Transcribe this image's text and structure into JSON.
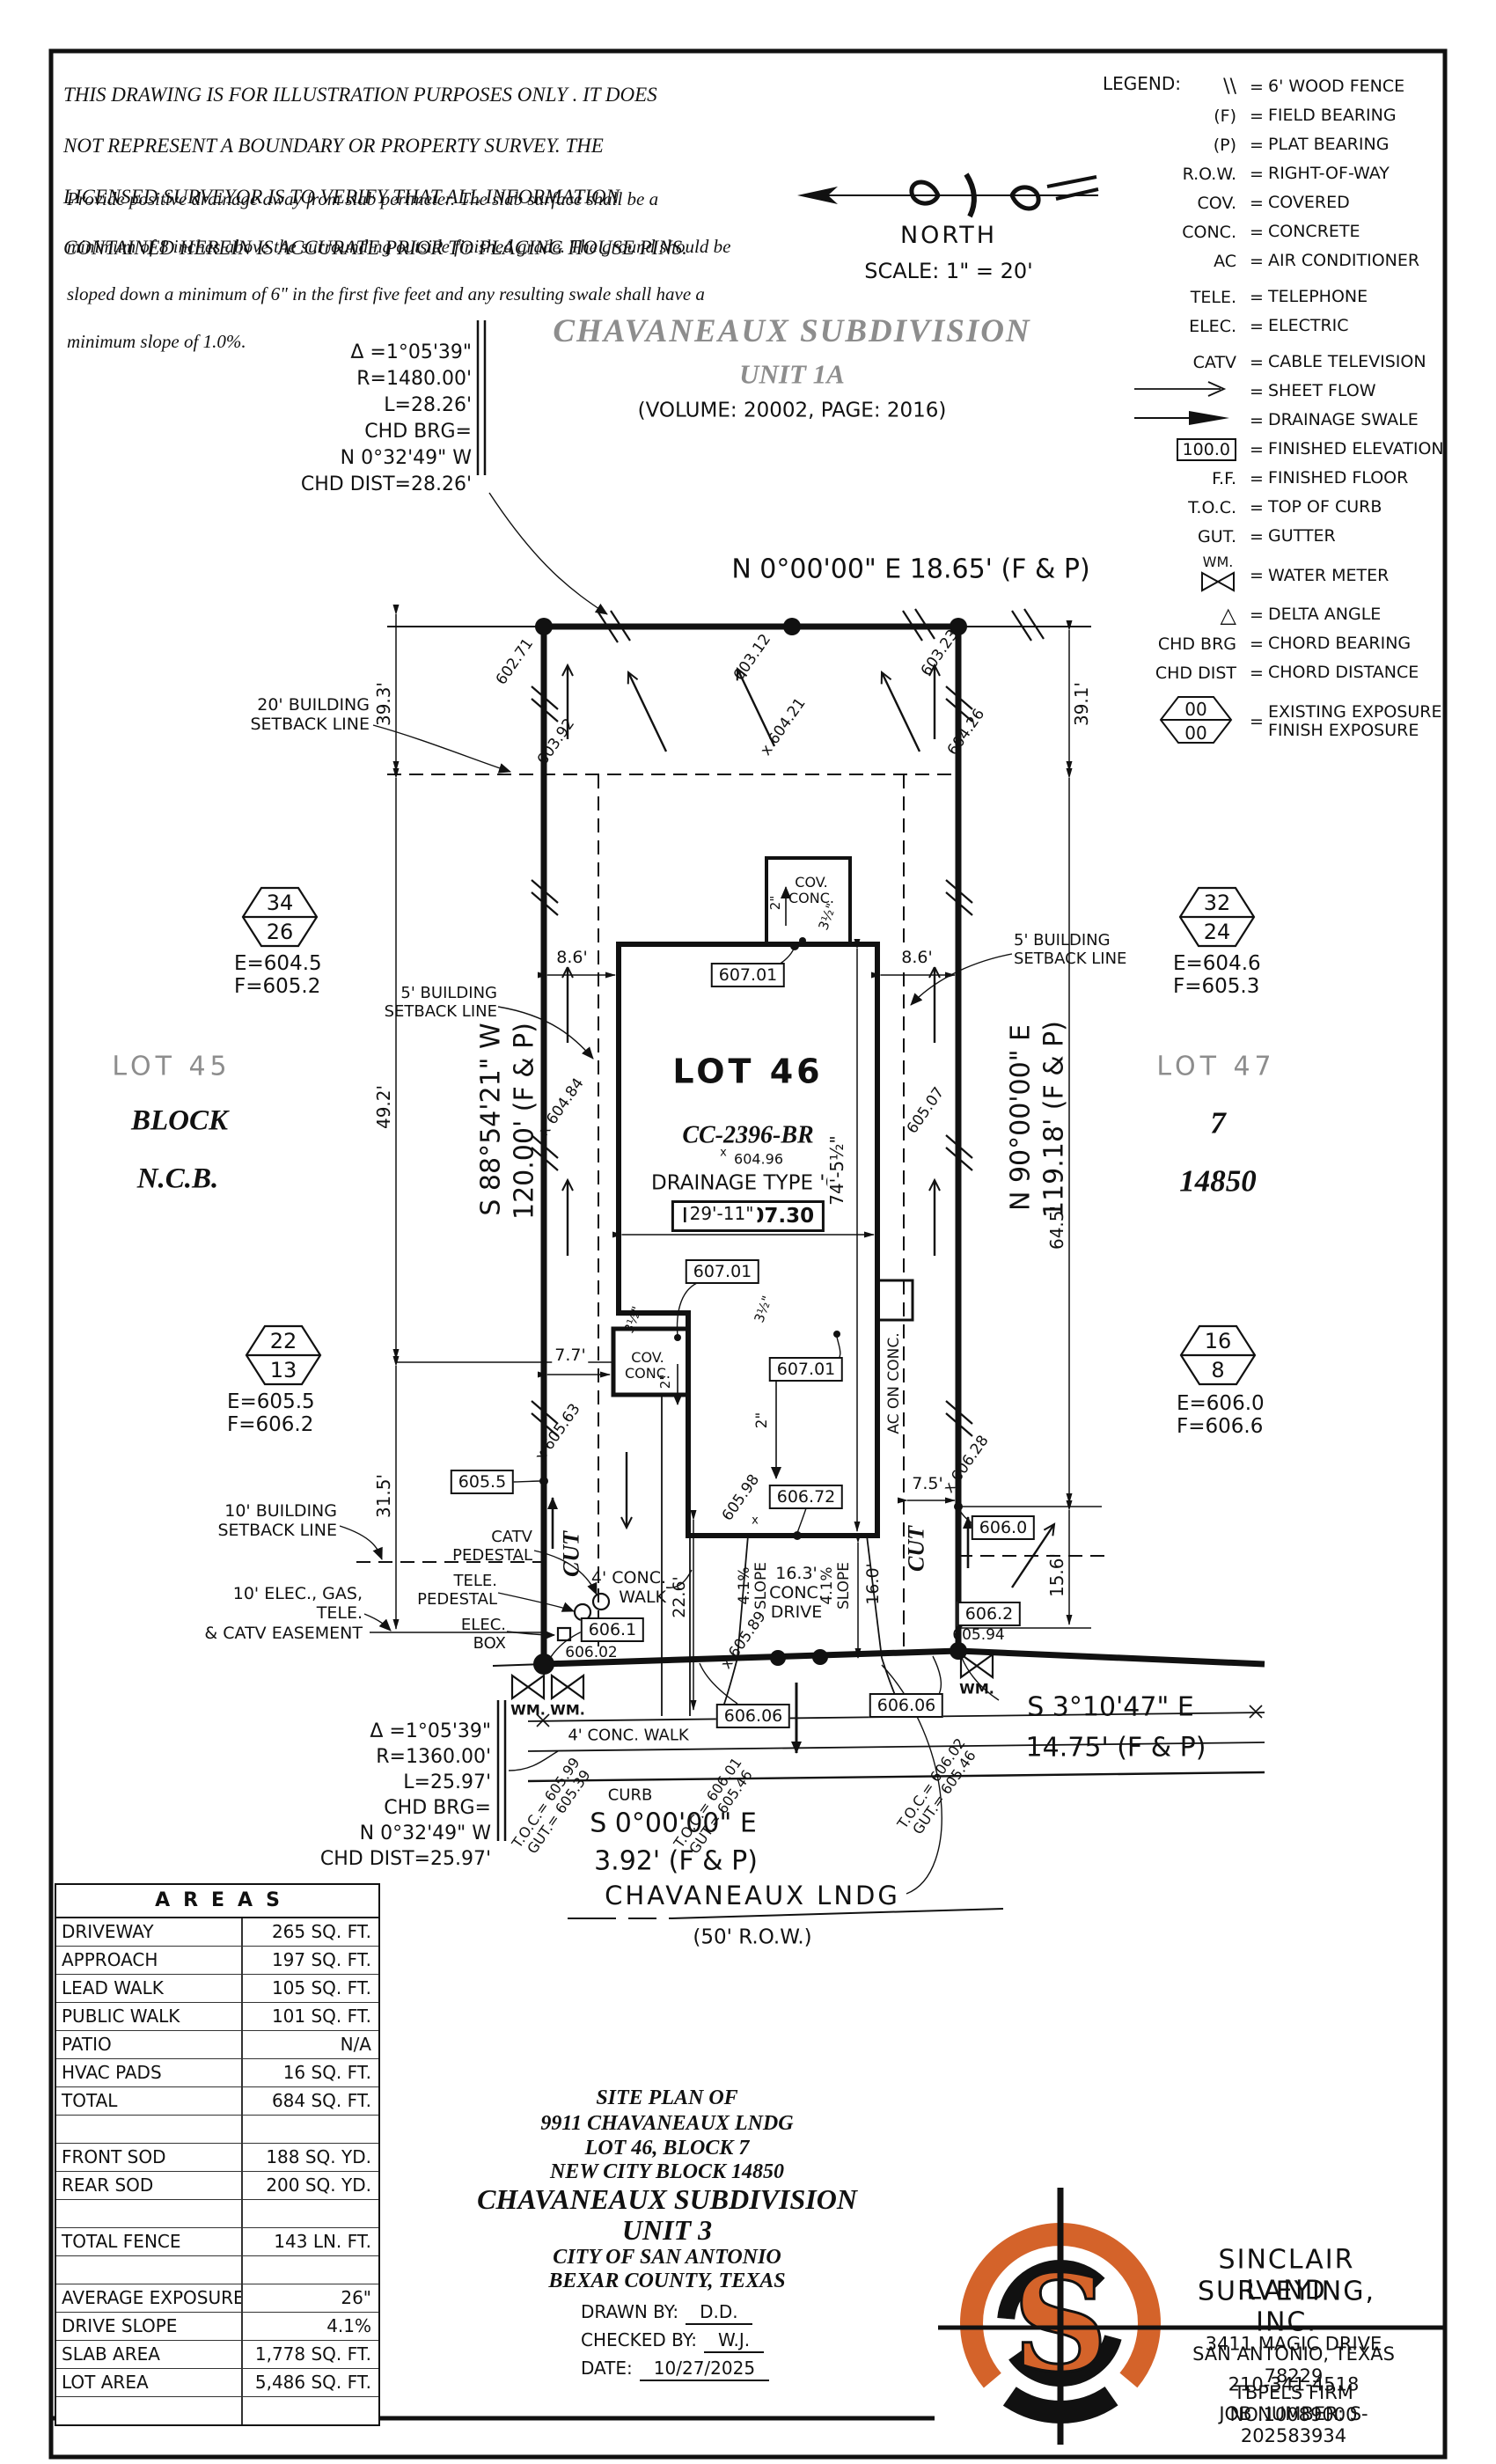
{
  "disclaimer": {
    "p1": [
      "THIS DRAWING IS FOR ILLUSTRATION PURPOSES ONLY . IT DOES",
      "NOT REPRESENT A BOUNDARY OR PROPERTY SURVEY. THE",
      "LICENSED SURVEYOR IS TO VERIFY THAT ALL INFORMATION",
      "CONTAINED HEREIN IS ACCURATE PRIOR TO PLACING HOUSE PINS."
    ],
    "p2": [
      "Provide positive drainage away from slab perimeter. The slab surface shall be a",
      "minimum of 8 inches above the surrounding outside finished grade. The ground should be",
      "sloped down a minimum of 6\" in the first five feet and any resulting swale shall have a",
      "minimum slope of 1.0%."
    ]
  },
  "north": {
    "label": "NORTH",
    "scale": "SCALE: 1\" = 20'"
  },
  "legend": {
    "title": "LEGEND:",
    "eq": "=",
    "hex00": "00",
    "rows": [
      {
        "s": "\\\\",
        "t": "6' WOOD FENCE"
      },
      {
        "s": "(F)",
        "t": "FIELD BEARING"
      },
      {
        "s": "(P)",
        "t": "PLAT BEARING"
      },
      {
        "s": "R.O.W.",
        "t": "RIGHT-OF-WAY"
      },
      {
        "s": "COV.",
        "t": "COVERED"
      },
      {
        "s": "CONC.",
        "t": "CONCRETE"
      },
      {
        "s": "AC",
        "t": "AIR CONDITIONER"
      },
      {
        "s": "TELE.",
        "t": "TELEPHONE"
      },
      {
        "s": "ELEC.",
        "t": "ELECTRIC"
      },
      {
        "s": "CATV",
        "t": "CABLE TELEVISION"
      },
      {
        "s": "",
        "t": "SHEET FLOW"
      },
      {
        "s": "",
        "t": "DRAINAGE SWALE"
      },
      {
        "s": "100.0",
        "t": "FINISHED ELEVATION"
      },
      {
        "s": "F.F.",
        "t": "FINISHED FLOOR"
      },
      {
        "s": "T.O.C.",
        "t": "TOP OF CURB"
      },
      {
        "s": "GUT.",
        "t": "GUTTER"
      },
      {
        "s": "WM.",
        "t": "WATER METER"
      },
      {
        "s": "△",
        "t": "DELTA ANGLE"
      },
      {
        "s": "CHD BRG",
        "t": "CHORD BEARING"
      },
      {
        "s": "CHD DIST",
        "t": "CHORD DISTANCE"
      },
      {
        "s": "",
        "t": "EXISTING EXPOSURE\nFINISH EXPOSURE"
      }
    ]
  },
  "plan": {
    "subdivision_title": "CHAVANEAUX SUBDIVISION",
    "subdivision_unit": "UNIT 1A",
    "subdivision_vol": "(VOLUME: 20002, PAGE: 2016)",
    "bearing_top": "N 0°00'00\" E 18.65' (F & P)",
    "bearing_left": "S 88°54'21\" W",
    "bearing_left_d": "120.00' (F & P)",
    "bearing_right": "N 90°00'00\" E",
    "bearing_right_d": "119.18' (F & P)",
    "bearing_front": "S 0°00'00\" E",
    "bearing_front_d": "3.92' (F & P)",
    "bearing_se": "S 3°10'47\" E",
    "bearing_se_d": "14.75' (F & P)",
    "street": "CHAVANEAUX LNDG",
    "street_row": "(50' R.O.W.)",
    "curve_top": [
      "Δ =1°05'39\"",
      "R=1480.00'",
      "L=28.26'",
      "CHD BRG=",
      "N 0°32'49\" W",
      "CHD DIST=28.26'"
    ],
    "curve_bot": [
      "Δ =1°05'39\"",
      "R=1360.00'",
      "L=25.97'",
      "CHD BRG=",
      "N 0°32'49\" W",
      "CHD DIST=25.97'"
    ],
    "lot45": "LOT 45",
    "block_l": "BLOCK",
    "ncb_l": "N.C.B.",
    "lot47": "LOT 47",
    "block_r": "7",
    "ncb_r": "14850",
    "lot46": "LOT 46",
    "plan_no": "CC-2396-BR",
    "spot_604": "604.96",
    "drainage": "DRAINAGE TYPE 'C'",
    "ff": "F.F.=607.30",
    "hex1": {
      "a": "34",
      "b": "26",
      "e": "E=604.5",
      "f": "F=605.2"
    },
    "hex2": {
      "a": "32",
      "b": "24",
      "e": "E=604.6",
      "f": "F=605.3"
    },
    "hex3": {
      "a": "22",
      "b": "13",
      "e": "E=605.5",
      "f": "F=606.2"
    },
    "hex4": {
      "a": "16",
      "b": "8",
      "e": "E=606.0",
      "f": "F=606.6"
    },
    "sb20": "20' BUILDING\nSETBACK LINE",
    "sb5": "5' BUILDING\nSETBACK LINE",
    "sb10": "10' BUILDING\nSETBACK LINE",
    "easement": "10' ELEC., GAS, TELE.\n& CATV EASEMENT",
    "catv": "CATV\nPEDESTAL",
    "tele": "TELE.\nPEDESTAL",
    "elec": "ELEC.\nBOX",
    "dims": {
      "d1": "39.3'",
      "d2": "39.1'",
      "d3": "49.2'",
      "d4": "31.5'",
      "d5": "64.5'",
      "d6": "15.6'",
      "d7": "8.6'",
      "d8": "29'-11\"",
      "d9": "74'-5½\"",
      "d10": "7.7'",
      "d11": "7.5'",
      "d12": "22.6'",
      "d13": "16.0'"
    },
    "drive": "16.3'\nCONC.\nDRIVE",
    "slope": "4.1%\nSLOPE",
    "walk": "4' CONC.\nWALK",
    "walk2": "4' CONC. WALK",
    "curb": "CURB",
    "cov": "COV.\nCONC.",
    "ac": "AC ON CONC.",
    "cut": "CUT",
    "wm": "WM.",
    "x": "x",
    "in2": "2\"",
    "in35": "3½\"",
    "spots": {
      "s1": "602.71",
      "s2": "603.12",
      "s3": "603.23",
      "s4": "603.92",
      "s5": "x 604.21",
      "s6": "604.26",
      "s7": "x 604.84",
      "s8": "605.07",
      "s9": "x 605.63",
      "s10": "605.98",
      "s11": "x 605.89",
      "s12": "x 606.28",
      "s13": "606.02",
      "s14": "605.94"
    },
    "boxes": {
      "b1": "607.01",
      "b2": "606.72",
      "b3": "605.5",
      "b4": "606.0",
      "b5": "606.2",
      "b6": "606.1",
      "b7": "606.06"
    },
    "toc1": "T.O.C.= 605.99\nGUT.= 605.39",
    "toc2": "T.O.C.= 606.01\nGUT.= 605.46",
    "toc3": "T.O.C.= 606.02\nGUT.= 605.46"
  },
  "areas": {
    "title": "AREAS",
    "rows": [
      {
        "l": "DRIVEWAY",
        "v": "265 SQ. FT."
      },
      {
        "l": "APPROACH",
        "v": "197 SQ. FT."
      },
      {
        "l": "LEAD WALK",
        "v": "105 SQ. FT."
      },
      {
        "l": "PUBLIC WALK",
        "v": "101 SQ. FT."
      },
      {
        "l": "PATIO",
        "v": "N/A"
      },
      {
        "l": "HVAC PADS",
        "v": "16 SQ. FT."
      },
      {
        "l": "TOTAL",
        "v": "684 SQ. FT."
      },
      {
        "l": "",
        "v": ""
      },
      {
        "l": "FRONT SOD",
        "v": "188 SQ. YD."
      },
      {
        "l": "REAR SOD",
        "v": "200 SQ. YD."
      },
      {
        "l": "",
        "v": ""
      },
      {
        "l": "TOTAL FENCE",
        "v": "143 LN. FT."
      },
      {
        "l": "",
        "v": ""
      },
      {
        "l": "AVERAGE EXPOSURE",
        "v": "26\""
      },
      {
        "l": "DRIVE SLOPE",
        "v": "4.1%"
      },
      {
        "l": "SLAB AREA",
        "v": "1,778 SQ. FT."
      },
      {
        "l": "LOT AREA",
        "v": "5,486 SQ. FT."
      },
      {
        "l": "",
        "v": ""
      }
    ]
  },
  "titleblock": {
    "lines": [
      "SITE PLAN OF",
      "9911 CHAVANEAUX LNDG",
      "LOT 46, BLOCK 7",
      "NEW CITY BLOCK 14850",
      "CHAVANEAUX SUBDIVISION",
      "UNIT 3",
      "CITY OF SAN ANTONIO",
      "BEXAR COUNTY, TEXAS"
    ],
    "drawn_label": "DRAWN BY:",
    "drawn": "D.D.",
    "checked_label": "CHECKED BY:",
    "checked": "W.J.",
    "date_label": "DATE:",
    "date": "10/27/2025"
  },
  "surveyor": {
    "s": "S",
    "name1": "SINCLAIR LAND",
    "name2": "SURVEYING, INC.",
    "addr1": "3411 MAGIC DRIVE",
    "addr2": "SAN ANTONIO, TEXAS 78229",
    "phone": "210-341-4518",
    "firm": "TBPELS FIRM NO.10089000",
    "job": "JOB NUMBER: S-202583934"
  },
  "colors": {
    "accent": "#d4632a",
    "line": "#111111"
  }
}
